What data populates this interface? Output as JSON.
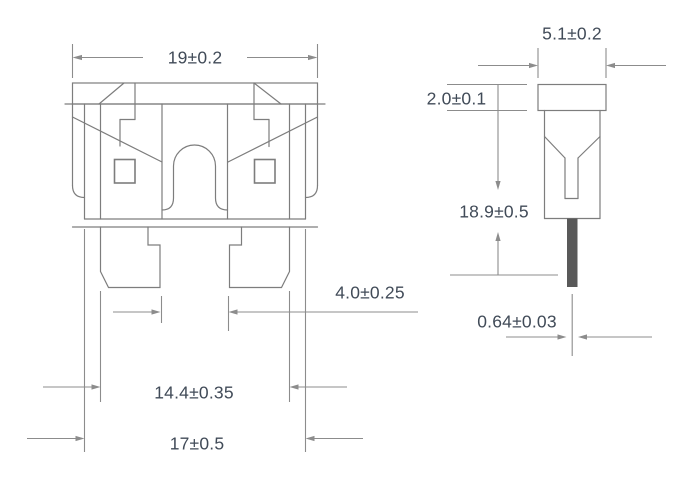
{
  "drawing": {
    "front_view": {
      "dim_overall_width": "19±0.2",
      "dim_blade_gap": "4.0±0.25",
      "dim_terminal_span": "14.4±0.35",
      "dim_base_width": "17±0.5"
    },
    "side_view": {
      "dim_thickness": "5.1±0.2",
      "dim_cap_height": "2.0±0.1",
      "dim_overall_height": "18.9±0.5",
      "dim_blade_thickness": "0.64±0.03"
    },
    "colors": {
      "line": "#7d7d7d",
      "dim_line": "#8c8c8c",
      "text": "#414b58",
      "blade_fill": "#595959",
      "background": "#ffffff"
    }
  }
}
